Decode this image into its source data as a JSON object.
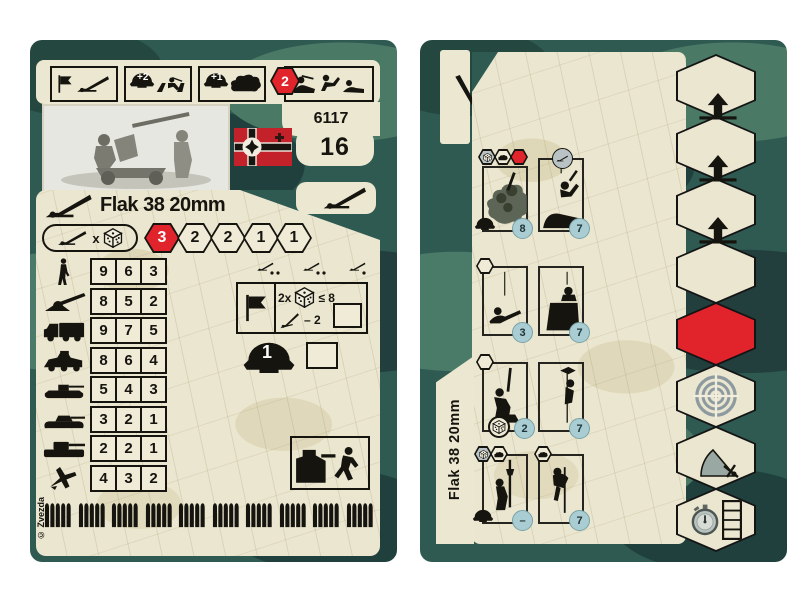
{
  "colors": {
    "card_green": "#2f5a52",
    "parchment": "#ebe6cf",
    "accent_red": "#e1232b",
    "flag_red": "#c3222b",
    "ink_black": "#15140f",
    "circle_teal": "#a9cdd3"
  },
  "left_card": {
    "top_banner": {
      "box2_badge": "+2",
      "box3_badge": "+1",
      "box4_badge": "2"
    },
    "product_code": "6117",
    "points": "16",
    "title": "Flak 38 20mm",
    "attack": {
      "multiplier_label": "x",
      "range_values": [
        "3",
        "2",
        "2",
        "1",
        "1"
      ]
    },
    "fire_table": {
      "rows": [
        {
          "target": "infantry",
          "values": [
            "9",
            "6",
            "3"
          ]
        },
        {
          "target": "field-gun",
          "values": [
            "8",
            "5",
            "2"
          ]
        },
        {
          "target": "truck",
          "values": [
            "9",
            "7",
            "5"
          ]
        },
        {
          "target": "armored-car",
          "values": [
            "8",
            "6",
            "4"
          ]
        },
        {
          "target": "light-tank",
          "values": [
            "5",
            "4",
            "3"
          ]
        },
        {
          "target": "medium-tank",
          "values": [
            "3",
            "2",
            "1"
          ]
        },
        {
          "target": "heavy-tank",
          "values": [
            "2",
            "2",
            "1"
          ]
        },
        {
          "target": "aircraft",
          "values": [
            "4",
            "3",
            "2"
          ]
        }
      ]
    },
    "support": {
      "multiplier": "2x",
      "threshold": "≤ 8",
      "penalty": "– 2"
    },
    "helmet_value": "1",
    "copyright": "© Zvezda"
  },
  "right_card": {
    "vertical_title": "Flak 38 20mm",
    "groups": [
      {
        "left_value": "8",
        "right_value": "7"
      },
      {
        "left_value": "3",
        "right_value": "7"
      },
      {
        "left_value": "2",
        "right_value": "7"
      },
      {
        "left_value": "–",
        "right_value": "7"
      }
    ]
  }
}
